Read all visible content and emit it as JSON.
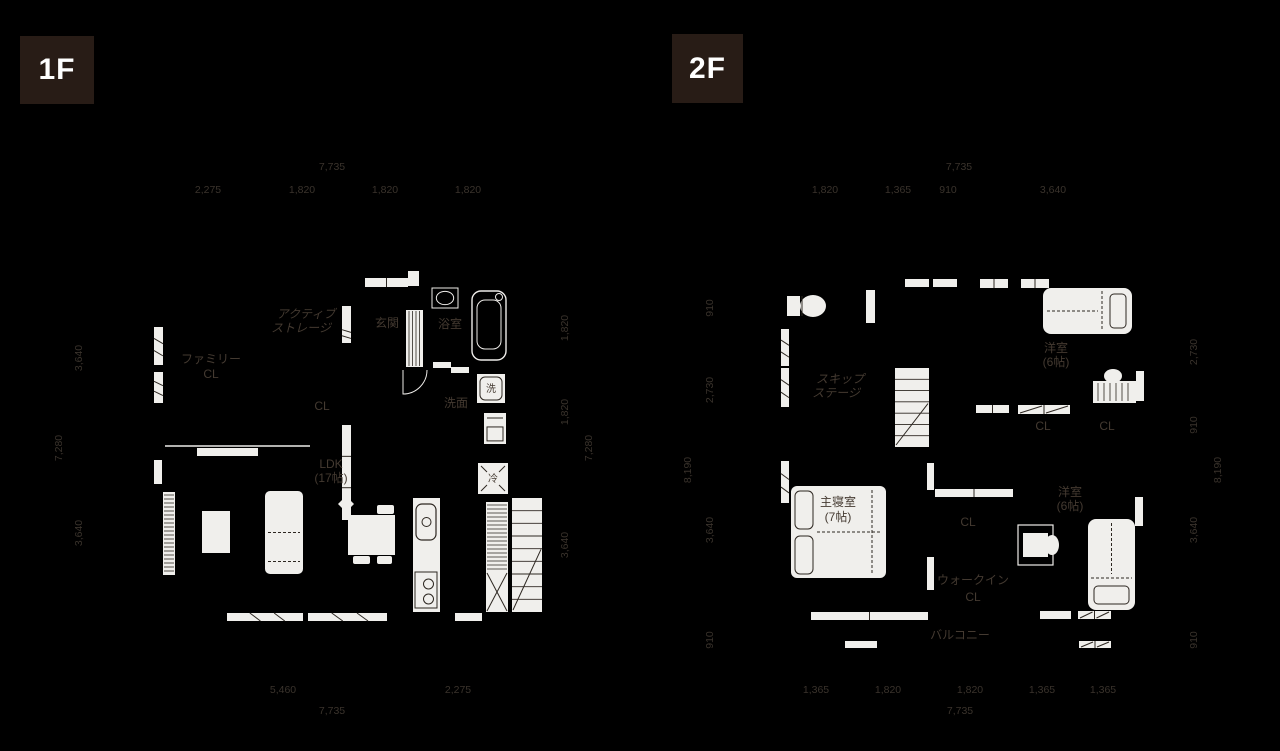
{
  "colors": {
    "background": "#000000",
    "badge_bg": "#281c16",
    "badge_text": "#ffffff",
    "line_white": "#eeece9",
    "fill_white": "#f0efec",
    "detail_dark": "#2d2721",
    "label_text": "#443a31",
    "dim_text": "#3a332c"
  },
  "canvas": {
    "w": 1280,
    "h": 751
  },
  "floors": [
    {
      "id": "1f",
      "badge": {
        "label": "1F",
        "x": 20,
        "y": 36,
        "w": 74,
        "h": 68
      },
      "labels": [
        {
          "text": "アクティブ",
          "x": 306,
          "y": 318,
          "skew": -14
        },
        {
          "text": "ストレージ",
          "x": 301,
          "y": 332,
          "skew": -14
        },
        {
          "text": "ファミリー",
          "x": 211,
          "y": 363
        },
        {
          "text": "CL",
          "x": 211,
          "y": 378
        },
        {
          "text": "玄関",
          "x": 387,
          "y": 327
        },
        {
          "text": "浴室",
          "x": 450,
          "y": 328
        },
        {
          "text": "洗",
          "x": 491,
          "y": 392,
          "size": 10
        },
        {
          "text": "洗面",
          "x": 456,
          "y": 407
        },
        {
          "text": "CL",
          "x": 322,
          "y": 410
        },
        {
          "text": "LDK",
          "x": 331,
          "y": 468
        },
        {
          "text": "(17帖)",
          "x": 331,
          "y": 482
        },
        {
          "text": "冷",
          "x": 493,
          "y": 482,
          "size": 10
        }
      ],
      "dims": [
        {
          "text": "7,735",
          "x": 332,
          "y": 170
        },
        {
          "text": "2,275",
          "x": 208,
          "y": 193
        },
        {
          "text": "1,820",
          "x": 302,
          "y": 193
        },
        {
          "text": "1,820",
          "x": 385,
          "y": 193
        },
        {
          "text": "1,820",
          "x": 468,
          "y": 193
        },
        {
          "text": "3,640",
          "x": 82,
          "y": 358,
          "rot": -90
        },
        {
          "text": "7,280",
          "x": 62,
          "y": 448,
          "rot": -90
        },
        {
          "text": "3,640",
          "x": 82,
          "y": 533,
          "rot": -90
        },
        {
          "text": "1,820",
          "x": 568,
          "y": 328,
          "rot": -90
        },
        {
          "text": "1,820",
          "x": 568,
          "y": 412,
          "rot": -90
        },
        {
          "text": "7,280",
          "x": 592,
          "y": 448,
          "rot": -90
        },
        {
          "text": "3,640",
          "x": 568,
          "y": 545,
          "rot": -90
        },
        {
          "text": "5,460",
          "x": 283,
          "y": 693
        },
        {
          "text": "2,275",
          "x": 458,
          "y": 693
        },
        {
          "text": "7,735",
          "x": 332,
          "y": 714
        }
      ],
      "fixtures": [
        {
          "t": "winO",
          "n": "porch-door",
          "x": 365,
          "y": 278,
          "w": 43,
          "h": 9,
          "mid": "v"
        },
        {
          "t": "bar",
          "n": "porch-step",
          "x": 408,
          "y": 271,
          "w": 11,
          "h": 15
        },
        {
          "t": "bar",
          "n": "storage-opening",
          "x": 342,
          "y": 306,
          "w": 9,
          "h": 18
        },
        {
          "t": "window",
          "n": "storage-window",
          "x": 342,
          "y": 324,
          "w": 9,
          "h": 19
        },
        {
          "t": "hatchV",
          "n": "entrance-floor",
          "x": 406,
          "y": 310,
          "w": 17,
          "h": 57
        },
        {
          "t": "window",
          "n": "window",
          "x": 154,
          "y": 327,
          "w": 9,
          "h": 38
        },
        {
          "t": "window",
          "n": "window",
          "x": 154,
          "y": 372,
          "w": 9,
          "h": 31
        },
        {
          "t": "bar",
          "n": "window",
          "x": 154,
          "y": 460,
          "w": 8,
          "h": 24
        },
        {
          "t": "line",
          "n": "partition-line",
          "x1": 165,
          "y1": 446,
          "x2": 310,
          "y2": 446
        },
        {
          "t": "bar",
          "n": "sliding-door",
          "x": 197,
          "y": 448,
          "w": 61,
          "h": 8
        },
        {
          "t": "window",
          "n": "window",
          "x": 227,
          "y": 613,
          "w": 76,
          "h": 8
        },
        {
          "t": "window",
          "n": "window",
          "x": 308,
          "y": 613,
          "w": 79,
          "h": 8
        },
        {
          "t": "bar",
          "n": "window",
          "x": 455,
          "y": 613,
          "w": 27,
          "h": 8
        },
        {
          "t": "winO",
          "n": "closet-door",
          "x": 342,
          "y": 425,
          "w": 9,
          "h": 95,
          "mid": "h"
        },
        {
          "t": "bar",
          "n": "sliding-door",
          "x": 433,
          "y": 362,
          "w": 18,
          "h": 6
        },
        {
          "t": "bar",
          "n": "sliding-door",
          "x": 451,
          "y": 367,
          "w": 18,
          "h": 6
        },
        {
          "t": "arc",
          "n": "door-swing",
          "x": 403,
          "y": 370,
          "r": 24
        },
        {
          "t": "bath",
          "n": "bathtub",
          "x": 472,
          "y": 291,
          "w": 34,
          "h": 69
        },
        {
          "t": "vanity",
          "n": "bath-counter",
          "x": 432,
          "y": 288,
          "w": 26,
          "h": 20
        },
        {
          "t": "washer",
          "n": "washing-machine",
          "x": 477,
          "y": 374,
          "w": 28,
          "h": 29
        },
        {
          "t": "vanity2",
          "n": "vanity-cabinet",
          "x": 484,
          "y": 413,
          "w": 22,
          "h": 31
        },
        {
          "t": "fridge",
          "n": "refrigerator",
          "x": 478,
          "y": 463,
          "w": 30,
          "h": 31
        },
        {
          "t": "kitchen",
          "n": "kitchen-counter",
          "x": 413,
          "y": 498,
          "w": 27,
          "h": 114
        },
        {
          "t": "pantry",
          "n": "pantry-shelf",
          "x": 486,
          "y": 502,
          "w": 22,
          "h": 70
        },
        {
          "t": "doorX",
          "n": "pantry-door",
          "x": 486,
          "y": 572,
          "w": 22,
          "h": 40
        },
        {
          "t": "stairs",
          "n": "stairs",
          "x": 512,
          "y": 498,
          "w": 30,
          "h": 114,
          "treads": 9
        },
        {
          "t": "tableF",
          "n": "dining-table",
          "x": 348,
          "y": 515,
          "w": 47,
          "h": 40
        },
        {
          "t": "chair",
          "n": "chair",
          "x": 377,
          "y": 505,
          "w": 17,
          "h": 9
        },
        {
          "t": "chair",
          "n": "chair",
          "x": 353,
          "y": 556,
          "w": 17,
          "h": 8
        },
        {
          "t": "chair",
          "n": "chair",
          "x": 377,
          "y": 556,
          "w": 15,
          "h": 8
        },
        {
          "t": "chairD",
          "n": "chair",
          "x": 338,
          "y": 496,
          "w": 16,
          "h": 16
        },
        {
          "t": "sofa",
          "n": "sofa",
          "x": 265,
          "y": 491,
          "w": 38,
          "h": 83
        },
        {
          "t": "tableF",
          "n": "coffee-table",
          "x": 202,
          "y": 511,
          "w": 28,
          "h": 42
        },
        {
          "t": "hatchH",
          "n": "tv-board",
          "x": 163,
          "y": 492,
          "w": 12,
          "h": 83
        }
      ]
    },
    {
      "id": "2f",
      "badge": {
        "label": "2F",
        "x": 672,
        "y": 34,
        "w": 71,
        "h": 69
      },
      "labels": [
        {
          "text": "スキップ",
          "x": 840,
          "y": 383,
          "skew": -14
        },
        {
          "text": "ステージ",
          "x": 836,
          "y": 397,
          "skew": -14
        },
        {
          "text": "洋室",
          "x": 1056,
          "y": 352
        },
        {
          "text": "(6帖)",
          "x": 1056,
          "y": 366
        },
        {
          "text": "CL",
          "x": 1043,
          "y": 430
        },
        {
          "text": "CL",
          "x": 1107,
          "y": 430
        },
        {
          "text": "主寝室",
          "x": 838,
          "y": 506
        },
        {
          "text": "(7帖)",
          "x": 838,
          "y": 521
        },
        {
          "text": "CL",
          "x": 968,
          "y": 526
        },
        {
          "text": "ウォークイン",
          "x": 973,
          "y": 584
        },
        {
          "text": "CL",
          "x": 973,
          "y": 601
        },
        {
          "text": "洋室",
          "x": 1070,
          "y": 496
        },
        {
          "text": "(6帖)",
          "x": 1070,
          "y": 510
        },
        {
          "text": "バルコニー",
          "x": 960,
          "y": 639
        }
      ],
      "dims": [
        {
          "text": "7,735",
          "x": 959,
          "y": 170
        },
        {
          "text": "1,820",
          "x": 825,
          "y": 193
        },
        {
          "text": "1,365",
          "x": 898,
          "y": 193
        },
        {
          "text": "910",
          "x": 948,
          "y": 193
        },
        {
          "text": "3,640",
          "x": 1053,
          "y": 193
        },
        {
          "text": "910",
          "x": 713,
          "y": 308,
          "rot": -90
        },
        {
          "text": "2,730",
          "x": 713,
          "y": 390,
          "rot": -90
        },
        {
          "text": "8,190",
          "x": 691,
          "y": 470,
          "rot": -90
        },
        {
          "text": "3,640",
          "x": 713,
          "y": 530,
          "rot": -90
        },
        {
          "text": "910",
          "x": 713,
          "y": 640,
          "rot": -90
        },
        {
          "text": "2,730",
          "x": 1197,
          "y": 352,
          "rot": -90
        },
        {
          "text": "910",
          "x": 1197,
          "y": 425,
          "rot": -90
        },
        {
          "text": "8,190",
          "x": 1221,
          "y": 470,
          "rot": -90
        },
        {
          "text": "3,640",
          "x": 1197,
          "y": 530,
          "rot": -90
        },
        {
          "text": "910",
          "x": 1197,
          "y": 640,
          "rot": -90
        },
        {
          "text": "1,365",
          "x": 816,
          "y": 693
        },
        {
          "text": "1,820",
          "x": 888,
          "y": 693
        },
        {
          "text": "1,820",
          "x": 970,
          "y": 693
        },
        {
          "text": "1,365",
          "x": 1042,
          "y": 693
        },
        {
          "text": "1,365",
          "x": 1103,
          "y": 693
        },
        {
          "text": "7,735",
          "x": 960,
          "y": 714
        }
      ],
      "fixtures": [
        {
          "t": "toilet",
          "n": "toilet",
          "x": 787,
          "y": 293,
          "w": 40,
          "h": 26
        },
        {
          "t": "window",
          "n": "window",
          "x": 781,
          "y": 329,
          "w": 8,
          "h": 37
        },
        {
          "t": "window",
          "n": "window",
          "x": 781,
          "y": 368,
          "w": 8,
          "h": 39
        },
        {
          "t": "window",
          "n": "window",
          "x": 781,
          "y": 461,
          "w": 8,
          "h": 42
        },
        {
          "t": "bar",
          "n": "door",
          "x": 866,
          "y": 290,
          "w": 9,
          "h": 33
        },
        {
          "t": "bar",
          "n": "window",
          "x": 905,
          "y": 279,
          "w": 24,
          "h": 8
        },
        {
          "t": "bar",
          "n": "window",
          "x": 933,
          "y": 279,
          "w": 24,
          "h": 8
        },
        {
          "t": "winO",
          "n": "window",
          "x": 980,
          "y": 279,
          "w": 28,
          "h": 9,
          "mid": "v"
        },
        {
          "t": "winO",
          "n": "window",
          "x": 1021,
          "y": 279,
          "w": 28,
          "h": 9,
          "mid": "v"
        },
        {
          "t": "stairs",
          "n": "stairs",
          "x": 895,
          "y": 368,
          "w": 34,
          "h": 79,
          "treads": 7
        },
        {
          "t": "bedS",
          "n": "single-bed",
          "x": 1043,
          "y": 288,
          "w": 89,
          "h": 46,
          "pillow": "right"
        },
        {
          "t": "chairE",
          "n": "chair",
          "x": 1113,
          "y": 376,
          "rx": 9,
          "ry": 7
        },
        {
          "t": "desk",
          "n": "desk",
          "x": 1093,
          "y": 381,
          "w": 43,
          "h": 22
        },
        {
          "t": "bar",
          "n": "window",
          "x": 1136,
          "y": 371,
          "w": 8,
          "h": 30
        },
        {
          "t": "winO",
          "n": "closet-door",
          "x": 976,
          "y": 405,
          "w": 33,
          "h": 8,
          "mid": "v"
        },
        {
          "t": "winO2",
          "n": "closet-door",
          "x": 1018,
          "y": 405,
          "w": 52,
          "h": 9
        },
        {
          "t": "bedD",
          "n": "double-bed",
          "x": 791,
          "y": 486,
          "w": 95,
          "h": 92
        },
        {
          "t": "bar",
          "n": "closet-door",
          "x": 927,
          "y": 463,
          "w": 7,
          "h": 27
        },
        {
          "t": "winO",
          "n": "closet-door",
          "x": 935,
          "y": 489,
          "w": 78,
          "h": 8,
          "mid": "v"
        },
        {
          "t": "desk2",
          "n": "desk",
          "x": 1018,
          "y": 525,
          "w": 35,
          "h": 40
        },
        {
          "t": "chairE",
          "n": "chair",
          "x": 1052,
          "y": 545,
          "rx": 7,
          "ry": 10
        },
        {
          "t": "bar",
          "n": "closet-door",
          "x": 927,
          "y": 557,
          "w": 7,
          "h": 33
        },
        {
          "t": "bedS",
          "n": "single-bed",
          "x": 1088,
          "y": 519,
          "w": 47,
          "h": 91,
          "pillow": "bottom"
        },
        {
          "t": "bar",
          "n": "window",
          "x": 1135,
          "y": 497,
          "w": 8,
          "h": 29
        },
        {
          "t": "winO",
          "n": "balcony-window",
          "x": 811,
          "y": 612,
          "w": 117,
          "h": 8,
          "mid": "v"
        },
        {
          "t": "bar",
          "n": "window",
          "x": 1040,
          "y": 611,
          "w": 31,
          "h": 8
        },
        {
          "t": "winO2",
          "n": "window",
          "x": 1078,
          "y": 611,
          "w": 33,
          "h": 8
        },
        {
          "t": "bar",
          "n": "balcony-rail",
          "x": 845,
          "y": 641,
          "w": 32,
          "h": 7
        },
        {
          "t": "winO2",
          "n": "balcony-rail",
          "x": 1079,
          "y": 641,
          "w": 32,
          "h": 7
        }
      ]
    }
  ]
}
